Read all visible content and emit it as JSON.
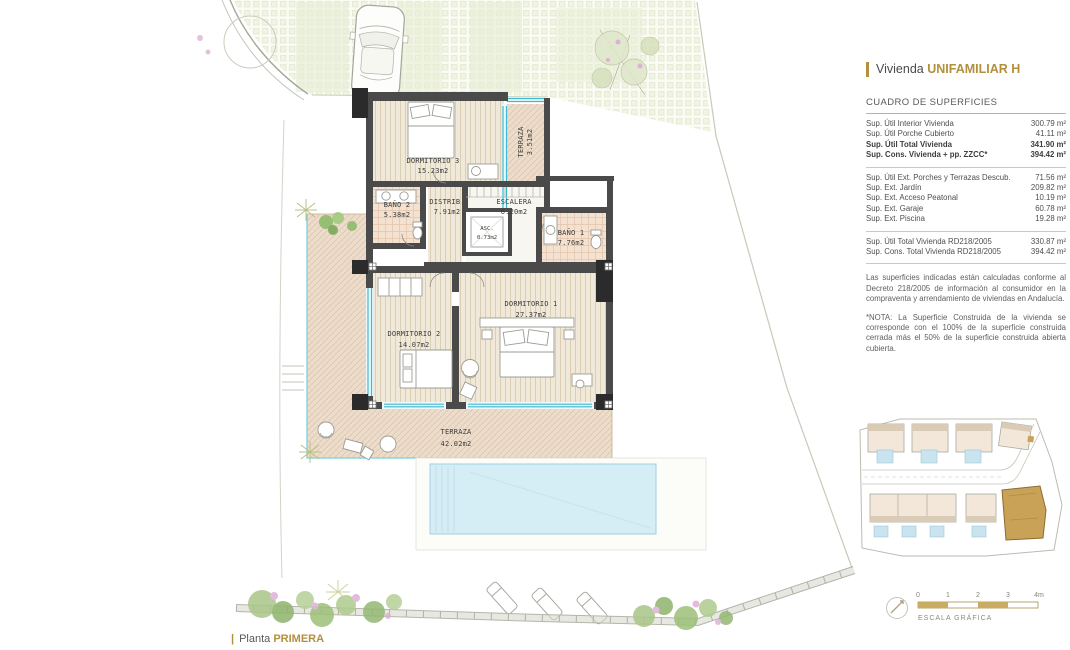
{
  "panel": {
    "header": {
      "prefix": "Vivienda",
      "name": "UNIFAMILIAR H"
    },
    "surfaces": {
      "title": "CUADRO DE SUPERFICIES",
      "groups": [
        {
          "rows": [
            {
              "label": "Sup. Útil Interior Vivienda",
              "value": "300.79 m²",
              "bold": false
            },
            {
              "label": "Sup. Útil Porche Cubierto",
              "value": "41.11 m²",
              "bold": false
            },
            {
              "label": "Sup. Útil Total Vivienda",
              "value": "341.90 m²",
              "bold": true
            },
            {
              "label": "Sup. Cons. Vivienda + pp. ZZCC*",
              "value": "394.42 m²",
              "bold": true
            }
          ]
        },
        {
          "rows": [
            {
              "label": "Sup. Útil Ext. Porches y Terrazas Descub.",
              "value": "71.56 m²",
              "bold": false
            },
            {
              "label": "Sup. Ext. Jardín",
              "value": "209.82 m²",
              "bold": false
            },
            {
              "label": "Sup. Ext. Acceso Peatonal",
              "value": "10.19 m²",
              "bold": false
            },
            {
              "label": "Sup. Ext. Garaje",
              "value": "60.78 m²",
              "bold": false
            },
            {
              "label": "Sup. Ext. Piscina",
              "value": "19.28 m²",
              "bold": false
            }
          ]
        },
        {
          "rows": [
            {
              "label": "Sup. Útil Total Vivienda RD218/2005",
              "value": "330.87 m²",
              "bold": false
            },
            {
              "label": "Sup. Cons. Total Vivienda RD218/2005",
              "value": "394.42 m²",
              "bold": false
            }
          ]
        }
      ]
    },
    "notes": [
      "Las superficies indicadas están calculadas conforme al Decreto 218/2005 de información al consumidor en la compraventa y arrendamiento de viviendas en Andalucía.",
      "*NOTA: La Superficie Construida de la vivienda se corresponde con el 100% de la superficie construida cerrada más el 50% de la superficie construida abierta cubierta."
    ]
  },
  "plan": {
    "rooms": [
      {
        "name": "DORMITORIO 3",
        "area": "15.23m2"
      },
      {
        "name": "TERRAZA",
        "area": "3.51m2"
      },
      {
        "name": "BAÑO 2",
        "area": "5.38m2"
      },
      {
        "name": "DISTRIB.",
        "area": "7.91m2"
      },
      {
        "name": "ESCALERA",
        "area": "6.20m2"
      },
      {
        "name": "ASC.",
        "area": "0.73m2"
      },
      {
        "name": "BAÑO 1",
        "area": "7.76m2"
      },
      {
        "name": "DORMITORIO 2",
        "area": "14.07m2"
      },
      {
        "name": "DORMITORIO 1",
        "area": "27.37m2"
      },
      {
        "name": "TERRAZA",
        "area": "42.02m2"
      }
    ],
    "caption": {
      "prefix": "Planta",
      "name": "PRIMERA"
    }
  },
  "scalebar": {
    "ticks": [
      "0",
      "1",
      "2",
      "3",
      "4m"
    ],
    "label": "ESCALA GRÁFICA"
  },
  "colors": {
    "accent": "#b3903d",
    "accent_light": "#c9ab62",
    "highlight_unit": "#c9a257",
    "wall": "#4a4a4a",
    "glass": "#3fb9cf",
    "pool": "#d5edf5",
    "wood_floor": "#f0e9da",
    "deck": "#eddecc",
    "tile": "#f5e1cf"
  }
}
